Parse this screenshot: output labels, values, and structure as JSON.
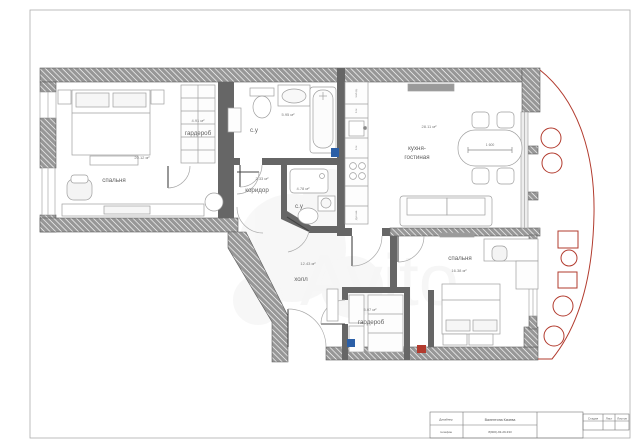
{
  "rooms": [
    {
      "id": "bedroom-left",
      "name": "спальня",
      "area": "20.12 м²"
    },
    {
      "id": "wardrobe-left",
      "name": "гардероб",
      "area": "4.91 м²"
    },
    {
      "id": "bathroom-top",
      "name": "с.у",
      "area": "5.95 м²"
    },
    {
      "id": "corridor",
      "name": "коридор",
      "area": "2.33 м²"
    },
    {
      "id": "bathroom-small",
      "name": "с.у",
      "area": "4.78 м²"
    },
    {
      "id": "kitchen-living",
      "name_line1": "кухня-",
      "name_line2": "гостиная",
      "area": "28.11 м²"
    },
    {
      "id": "hall",
      "name": "холл",
      "area": "12.43 м²"
    },
    {
      "id": "wardrobe-hall",
      "name": "гардероб",
      "area": "5.07 м²"
    },
    {
      "id": "bedroom-right",
      "name": "спальня",
      "area": "16.38 м²"
    }
  ],
  "dimensions": {
    "dining_table_width": "1 600"
  },
  "kitchen_units": {
    "fridge_label": "холод.",
    "unit_label_1": "п.м",
    "unit_label_2": "п.м",
    "oven_label": "дух.шк."
  },
  "title_block": {
    "designer_label": "Дизайнер",
    "designer_name": "Валентина Качева",
    "phone_label": "телефон",
    "phone_number": "8(900)-93-29-333",
    "stage_label": "Стадия",
    "sheet_label": "Лист",
    "sheets_label": "Листов"
  },
  "watermark": {
    "text": "Avito"
  },
  "colors": {
    "wall_hatch": "#979797",
    "interior_wall": "#666666",
    "balcony_red": "#b23b2e",
    "marker_blue": "#2b5fa7",
    "furniture_line": "#9f9f9f"
  }
}
